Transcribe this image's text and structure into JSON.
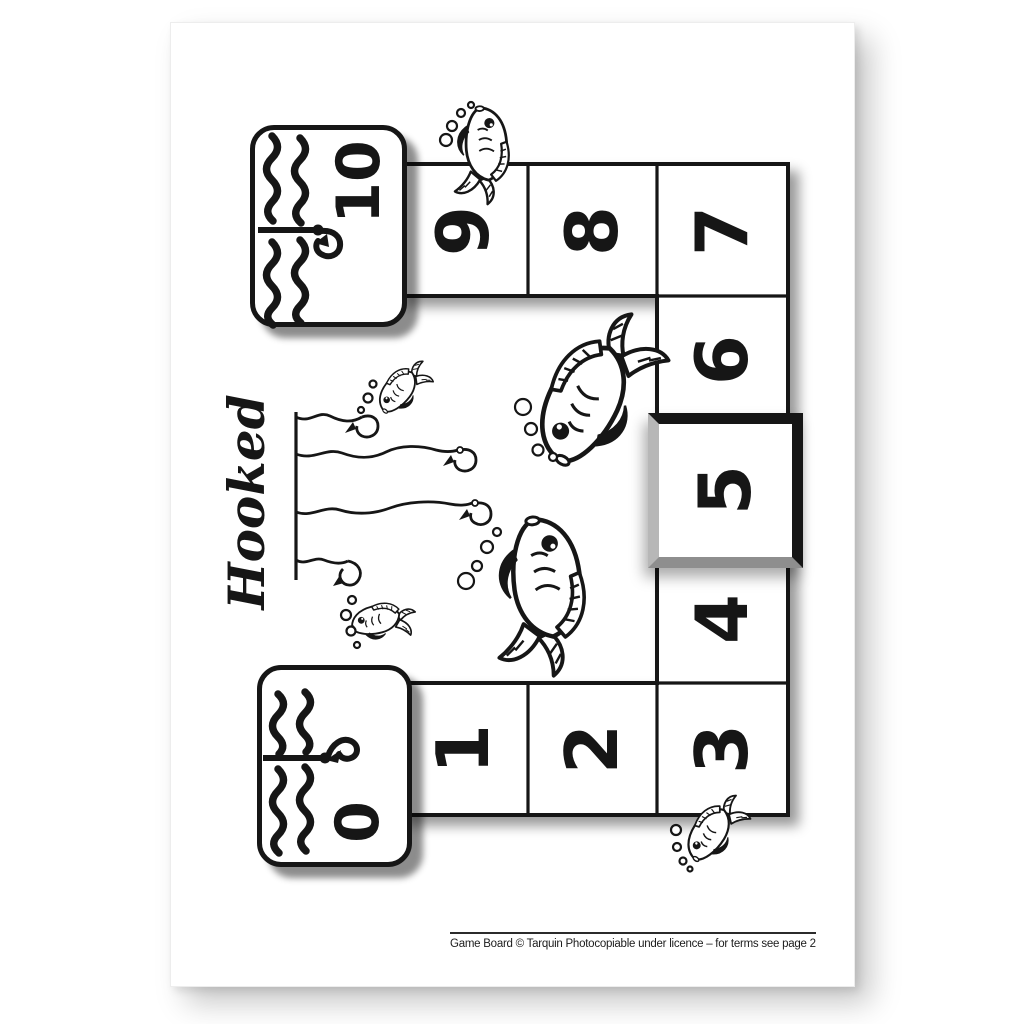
{
  "page": {
    "title": "Hooked",
    "footer": "Game Board © Tarquin Photocopiable under licence – for terms see page 2"
  },
  "board": {
    "type": "number-track game board, 0 to 10, rotated 90 degrees on portrait page",
    "start": {
      "value": "0"
    },
    "finish": {
      "value": "10"
    },
    "cells": [
      {
        "value": "1"
      },
      {
        "value": "2"
      },
      {
        "value": "3"
      },
      {
        "value": "4"
      },
      {
        "value": "5"
      },
      {
        "value": "6"
      },
      {
        "value": "7"
      },
      {
        "value": "8"
      },
      {
        "value": "9"
      }
    ],
    "highlight": {
      "cell": "5",
      "style": "thick black square frame"
    },
    "ink_color": "#161616",
    "paper_color": "#ffffff"
  },
  "icons": {
    "waves": "water-waves-icon",
    "hook": "fish-hook-icon",
    "fish": "fish-icon",
    "bubbles": "bubbles-icon",
    "fishing_line": "fishing-line-icon"
  }
}
